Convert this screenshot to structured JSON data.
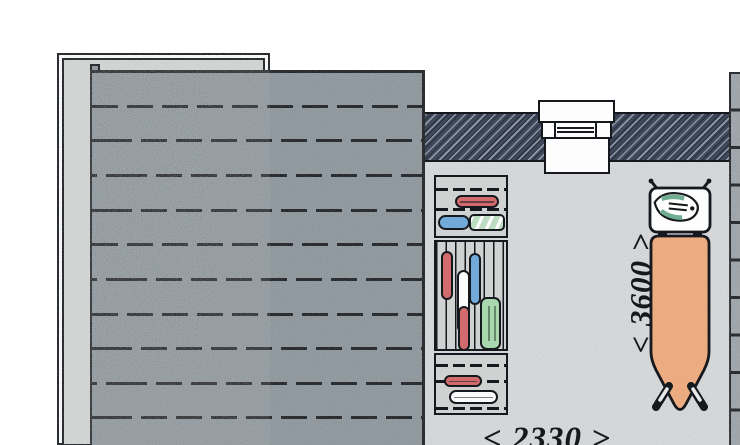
{
  "plan": {
    "dimension_vertical": {
      "label": "< 3600 >"
    },
    "dimension_horizontal": {
      "label": "< 2330 >"
    },
    "objects": {
      "deck": "plank deck terrace",
      "exterior_wall": "hatched wall with window",
      "shelving_unit": "three-section shelf with stored items",
      "ironing_board": "ironing board with iron on rest"
    },
    "colors": {
      "outline": "#15181c",
      "deck_plank": "#8a949b",
      "frame_fill": "#d5d7d7",
      "floor": "#d8dadc",
      "wall": "#3f495c",
      "wall_strip": "#9ba3a9",
      "cabinet_body": "#d0d2d2",
      "board_top": "#ecab80",
      "iron_accent": "#6fae93",
      "item_red": "#d26b6e",
      "item_blue": "#71aad9",
      "item_green_roll": "#bedec4",
      "item_green_box": "#a8d7ad",
      "item_white": "#fbfbfb"
    }
  }
}
